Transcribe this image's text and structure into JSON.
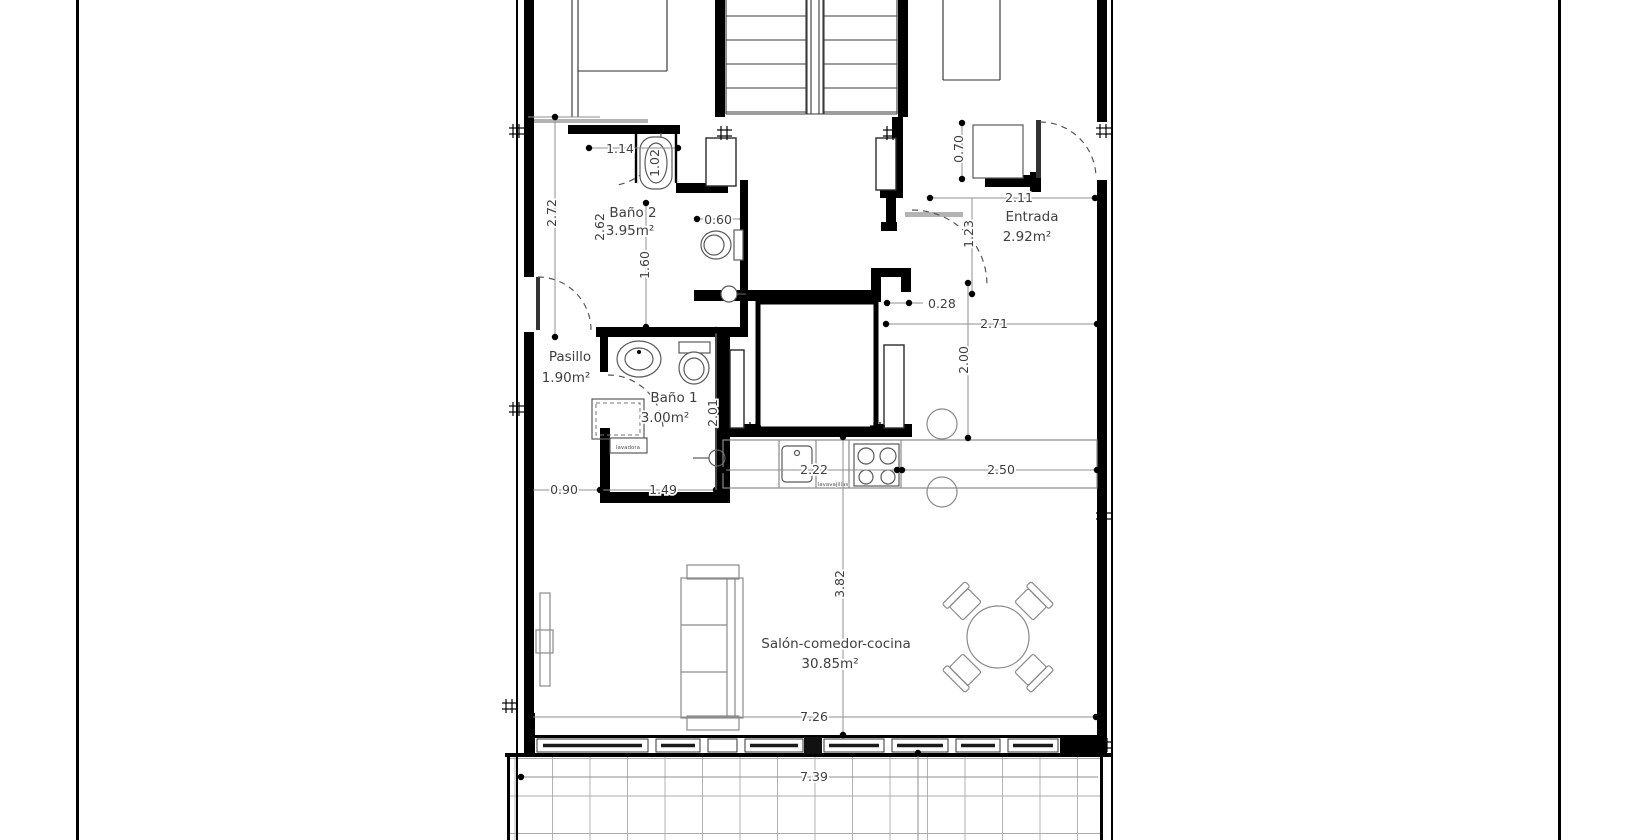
{
  "plan": {
    "type": "apartment-floor-plan",
    "units": "m",
    "rooms": {
      "bano2": {
        "name": "Baño 2",
        "area": "3.95m²"
      },
      "bano1": {
        "name": "Baño 1",
        "area": "3.00m²"
      },
      "pasillo": {
        "name": "Pasillo",
        "area": "1.90m²"
      },
      "entrada": {
        "name": "Entrada",
        "area": "2.92m²"
      },
      "salon": {
        "name": "Salón-comedor-cocina",
        "area": "30.85m²"
      }
    },
    "dimensions": {
      "d272": "2.72",
      "d114": "1.14",
      "d102": "1.02",
      "d060": "0.60",
      "d262": "2.62",
      "d160": "1.60",
      "d070": "0.70",
      "d211": "2.11",
      "d123": "1.23",
      "d028": "0.28",
      "d271": "2.71",
      "d200": "2.00",
      "d090": "0.90",
      "d149": "1.49",
      "d201": "2.01",
      "d222": "2.22",
      "d250": "2.50",
      "d382": "3.82",
      "d726": "7.26",
      "d739": "7.39"
    },
    "appliances": {
      "dishwasher": "lavavajillas",
      "washer": "lavadora"
    }
  }
}
